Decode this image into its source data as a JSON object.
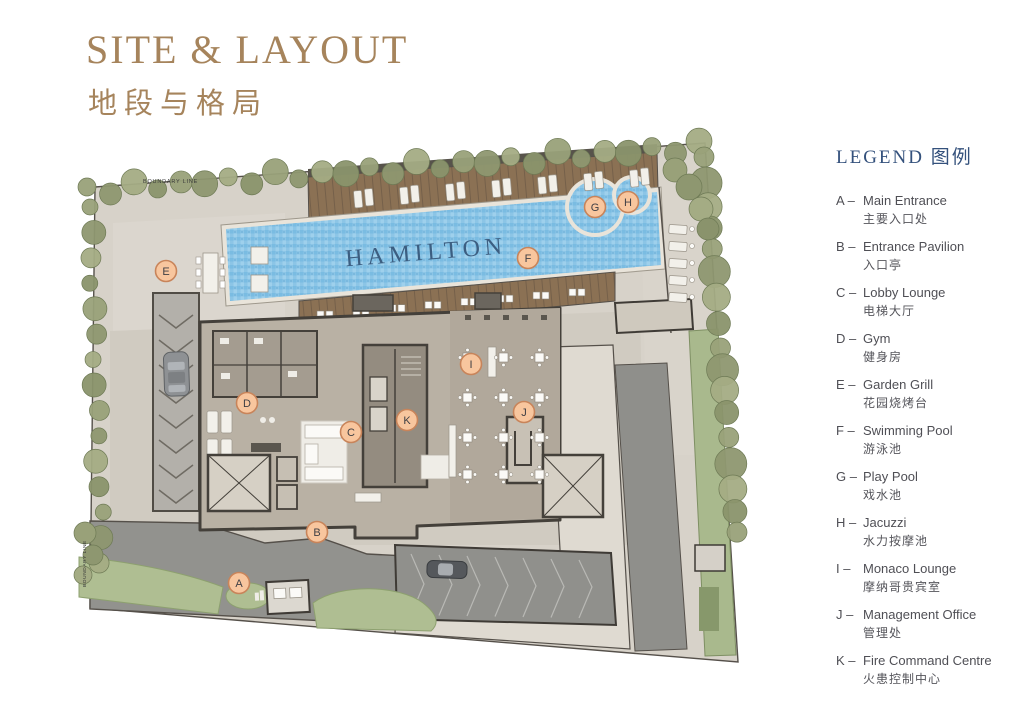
{
  "header": {
    "title": "SITE & LAYOUT",
    "subtitle": "地段与格局"
  },
  "legend": {
    "title_en": "LEGEND",
    "title_zh": "图例",
    "items": [
      {
        "key": "A",
        "en": "Main Entrance",
        "zh": "主要入口处"
      },
      {
        "key": "B",
        "en": "Entrance Pavilion",
        "zh": "入口亭"
      },
      {
        "key": "C",
        "en": "Lobby Lounge",
        "zh": "电梯大厅"
      },
      {
        "key": "D",
        "en": "Gym",
        "zh": "健身房"
      },
      {
        "key": "E",
        "en": "Garden Grill",
        "zh": "花园烧烤台"
      },
      {
        "key": "F",
        "en": "Swimming Pool",
        "zh": "游泳池"
      },
      {
        "key": "G",
        "en": "Play Pool",
        "zh": "戏水池"
      },
      {
        "key": "H",
        "en": "Jacuzzi",
        "zh": "水力按摩池"
      },
      {
        "key": "I",
        "en": "Monaco Lounge",
        "zh": "摩纳哥贵宾室"
      },
      {
        "key": "J",
        "en": "Management Office",
        "zh": "管理处"
      },
      {
        "key": "K",
        "en": "Fire Command Centre",
        "zh": "火患控制中心"
      }
    ]
  },
  "plan": {
    "watermark": "HAMILTON",
    "boundary_label_top": "BOUNDARY LINE",
    "boundary_label_left": "BOUNDARY LINE",
    "markers": [
      {
        "key": "A",
        "x": 184,
        "y": 458
      },
      {
        "key": "B",
        "x": 262,
        "y": 407
      },
      {
        "key": "C",
        "x": 296,
        "y": 307
      },
      {
        "key": "D",
        "x": 192,
        "y": 278
      },
      {
        "key": "E",
        "x": 111,
        "y": 146
      },
      {
        "key": "F",
        "x": 473,
        "y": 133
      },
      {
        "key": "G",
        "x": 540,
        "y": 82
      },
      {
        "key": "H",
        "x": 573,
        "y": 77
      },
      {
        "key": "I",
        "x": 416,
        "y": 239
      },
      {
        "key": "J",
        "x": 469,
        "y": 287
      },
      {
        "key": "K",
        "x": 352,
        "y": 295
      }
    ]
  },
  "colors": {
    "title": "#A6845C",
    "legend_header": "#34517C",
    "legend_text": "#4F4F55",
    "marker_fill": "#F8C69E",
    "marker_border": "#C8845A",
    "marker_text": "#3F3F44",
    "pool_water": "#8CC5E6",
    "pool_text": "#3C5E81",
    "wood_deck": "#8B7154",
    "tree": "#99A179",
    "grass": "#AFBE92",
    "driveway": "#92928E",
    "paving": "#D7D2C9"
  }
}
